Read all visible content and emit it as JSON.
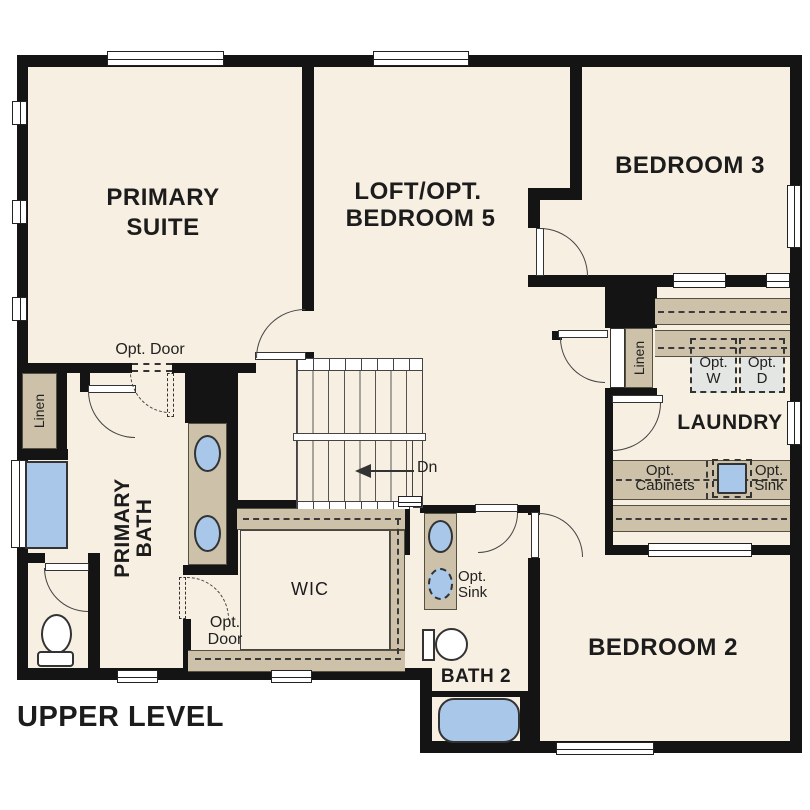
{
  "title": "UPPER LEVEL",
  "colors": {
    "floor": "#f7efe2",
    "wall": "#141414",
    "cabinet": "#cdc2a9",
    "blue": "#a9c8e9",
    "appliance": "#e4e6e4",
    "line": "#3a3a3a"
  },
  "rooms": {
    "primary_suite": {
      "line1": "PRIMARY",
      "line2": "SUITE"
    },
    "loft": {
      "line1": "LOFT/OPT.",
      "line2": "BEDROOM 5"
    },
    "bedroom3": {
      "label": "BEDROOM 3"
    },
    "laundry": {
      "label": "LAUNDRY"
    },
    "bedroom2": {
      "label": "BEDROOM 2"
    },
    "bath2": {
      "label": "BATH 2"
    },
    "wic": {
      "label": "WIC"
    },
    "primary_bath": {
      "line1": "PRIMARY",
      "line2": "BATH"
    }
  },
  "labels": {
    "opt_door_suite": "Opt. Door",
    "opt_door_wic": {
      "line1": "Opt.",
      "line2": "Door"
    },
    "linen_left": "Linen",
    "linen_right": "Linen",
    "dn": "Dn",
    "opt_w": {
      "line1": "Opt.",
      "line2": "W"
    },
    "opt_d": {
      "line1": "Opt.",
      "line2": "D"
    },
    "opt_cabinets": {
      "line1": "Opt.",
      "line2": "Cabinets"
    },
    "opt_sink_laundry": {
      "line1": "Opt.",
      "line2": "Sink"
    },
    "opt_sink_bath2": {
      "line1": "Opt.",
      "line2": "Sink"
    }
  }
}
